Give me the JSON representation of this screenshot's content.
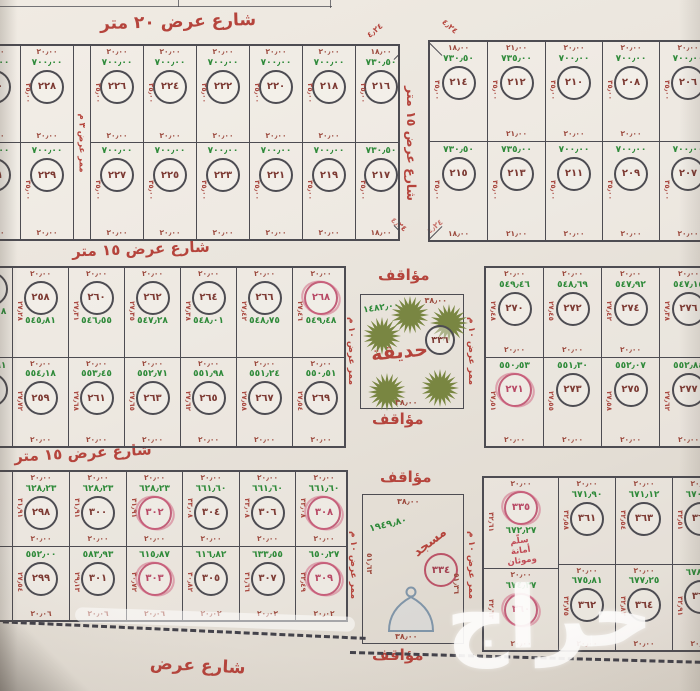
{
  "colors": {
    "red": "#b5443c",
    "maroon": "#9c4a3e",
    "green": "#2f8a3a",
    "pink": "#c2607a",
    "line": "#4d4c52",
    "paper": "#eae5dd"
  },
  "streets": {
    "top": "شارع عرض ٢٠ متر",
    "between_blocks": "شارع عرض ١٥ متر",
    "middle_a": "شارع عرض ١٥ متر",
    "middle_b": "شارع عرض ١٥ متر",
    "bottom": "شارع عرض",
    "corner_dim": "٤٫٢٤"
  },
  "labels": {
    "parking": "مؤاقف",
    "walkway_10": "ممر عرض ١٠ م",
    "walkway_3": "ممر عرض ٣ م"
  },
  "park": {
    "title": "حديقة",
    "number": "٣٣٦",
    "area": "١٤٨٢٫٠٠",
    "width_top": "٣٨٫٠٠",
    "width_bottom": "٣٨٫٠٠",
    "trees": [
      {
        "x": 49,
        "y": 20
      },
      {
        "x": 21,
        "y": 41
      },
      {
        "x": 88,
        "y": 28
      },
      {
        "x": 26,
        "y": 97
      },
      {
        "x": 79,
        "y": 93
      }
    ]
  },
  "mosque": {
    "title": "مسجد",
    "number": "٣٣٤",
    "area": "١٩٤٩٫٨٠",
    "width_top": "٣٨٫٠٠",
    "width_bottom": "٣٨٫٠٠",
    "side_left": "٥١٫٦٣",
    "side_right": "٥١٫٣٦"
  },
  "watermark": "حراج",
  "blocks": {
    "top_left": {
      "columns": [
        {
          "w": 52,
          "ml": -32,
          "top": {
            "wt": "٢٠٫٠٠",
            "area": "٧٠٠٫٠٠",
            "num": "٢٣٠",
            "side": "٣٥٫٠٠",
            "wb": "٢٠٫٠٠"
          },
          "bottom": {
            "area": "٧٠٠٫٠٠",
            "num": "٢٣١",
            "side": "٣٥٫٠٠",
            "wb": "٢٠٫٠٠"
          }
        },
        {
          "w": 52,
          "top": {
            "wt": "٢٠٫٠٠",
            "area": "٧٠٠٫٠٠",
            "num": "٢٢٨",
            "side": "٣٥٫٠٠",
            "wb": "٢٠٫٠٠"
          },
          "bottom": {
            "area": "٧٠٠٫٠٠",
            "num": "٢٢٩",
            "side": "٣٥٫٠٠",
            "wb": "٢٠٫٠٠"
          }
        },
        {
          "w": 16,
          "walkway": true
        },
        {
          "w": 52,
          "top": {
            "wt": "٢٠٫٠٠",
            "area": "٧٠٠٫٠٠",
            "num": "٢٢٦",
            "side": "٣٥٫٠٠",
            "wb": "٢٠٫٠٠"
          },
          "bottom": {
            "area": "٧٠٠٫٠٠",
            "num": "٢٢٧",
            "side": "٣٥٫٠٠",
            "wb": "٢٠٫٠٠"
          }
        },
        {
          "w": 52,
          "top": {
            "wt": "٢٠٫٠٠",
            "area": "٧٠٠٫٠٠",
            "num": "٢٢٤",
            "side": "٣٥٫٠٠",
            "wb": "٢٠٫٠٠"
          },
          "bottom": {
            "area": "٧٠٠٫٠٠",
            "num": "٢٢٥",
            "side": "٣٥٫٠٠",
            "wb": "٢٠٫٠٠"
          }
        },
        {
          "w": 52,
          "top": {
            "wt": "٢٠٫٠٠",
            "area": "٧٠٠٫٠٠",
            "num": "٢٢٢",
            "side": "٣٥٫٠٠",
            "wb": "٢٠٫٠٠"
          },
          "bottom": {
            "area": "٧٠٠٫٠٠",
            "num": "٢٢٣",
            "side": "٣٥٫٠٠",
            "wb": "٢٠٫٠٠"
          }
        },
        {
          "w": 52,
          "top": {
            "wt": "٢٠٫٠٠",
            "area": "٧٠٠٫٠٠",
            "num": "٢٢٠",
            "side": "٣٥٫٠٠",
            "wb": "٢٠٫٠٠"
          },
          "bottom": {
            "area": "٧٠٠٫٠٠",
            "num": "٢٢١",
            "side": "٣٥٫٠٠",
            "wb": "٢٠٫٠٠"
          }
        },
        {
          "w": 52,
          "top": {
            "wt": "٢٠٫٠٠",
            "area": "٧٠٠٫٠٠",
            "num": "٢١٨",
            "side": "٣٥٫٠٠",
            "wb": "٢٠٫٠٠"
          },
          "bottom": {
            "area": "٧٠٠٫٠٠",
            "num": "٢١٩",
            "side": "٣٥٫٠٠",
            "wb": "٢٠٫٠٠"
          }
        },
        {
          "w": 50,
          "top": {
            "wt": "١٨٫٠٠",
            "area": "٧٣٠٫٥٠",
            "num": "٢١٦",
            "side": "٣٥٫٠٠",
            "cut": "tr"
          },
          "bottom": {
            "area": "٧٣٠٫٥٠",
            "num": "٢١٧",
            "side": "٣٥٫٠٠",
            "wb": "١٨٫٠٠",
            "cut": "br"
          }
        }
      ]
    },
    "top_right": {
      "columns": [
        {
          "w": 57,
          "top": {
            "wt": "١٨٫٠٠",
            "area": "٧٣٠٫٥٠",
            "num": "٢١٤",
            "side": "٣٥٫٠٠",
            "cut": "tl"
          },
          "bottom": {
            "area": "٧٣٠٫٥٠",
            "num": "٢١٥",
            "side": "٣٥٫٠٠",
            "wb": "١٨٫٠٠",
            "cut": "bl"
          }
        },
        {
          "w": 57,
          "top": {
            "wt": "٢١٫٠٠",
            "area": "٧٣٥٫٠٠",
            "num": "٢١٢",
            "side": "٣٥٫٠٠",
            "wb": "٢١٫٠٠"
          },
          "bottom": {
            "area": "٧٣٥٫٠٠",
            "num": "٢١٣",
            "side": "٣٥٫٠٠",
            "wb": "٢١٫٠٠"
          }
        },
        {
          "w": 56,
          "top": {
            "wt": "٢٠٫٠٠",
            "area": "٧٠٠٫٠٠",
            "num": "٢١٠",
            "side": "٣٥٫٠٠",
            "wb": "٢٠٫٠٠"
          },
          "bottom": {
            "area": "٧٠٠٫٠٠",
            "num": "٢١١",
            "side": "٣٥٫٠٠",
            "wb": "٢٠٫٠٠"
          }
        },
        {
          "w": 56,
          "top": {
            "wt": "٢٠٫٠٠",
            "area": "٧٠٠٫٠٠",
            "num": "٢٠٨",
            "side": "٣٥٫٠٠",
            "wb": "٢٠٫٠٠"
          },
          "bottom": {
            "area": "٧٠٠٫٠٠",
            "num": "٢٠٩",
            "side": "٣٥٫٠٠",
            "wb": "٢٠٫٠٠"
          }
        },
        {
          "w": 56,
          "mr": -10,
          "top": {
            "wt": "٢٠٫٠٠",
            "area": "٧٠٠٫٠٠",
            "num": "٢٠٦",
            "side": "٣٥٫٠٠"
          },
          "bottom": {
            "area": "٧٠٠٫٠٠",
            "num": "٢٠٧",
            "side": "٣٥٫٠٠",
            "wb": "٢٠٫٠٠"
          }
        }
      ]
    },
    "mid_left": {
      "columns": [
        {
          "w": 42,
          "ml": -30,
          "top": {
            "num": "٢٥٦",
            "area": "٥٤٥٫٠٨"
          },
          "bottom": {
            "num": "٢٥٧",
            "area": "٥٥٤٫٩١"
          }
        },
        {
          "w": 55,
          "top": {
            "wt": "٢٠٫٠٠",
            "num": "٢٥٨",
            "area": "٥٤٥٫٨١",
            "side": "٢٧٫٢٨"
          },
          "bottom": {
            "wt": "٢٠٫٠٠",
            "area": "٥٥٤٫١٨",
            "num": "٢٥٩",
            "side": "٢٧٫٧٢",
            "wb": "٢٠٫٠٠"
          }
        },
        {
          "w": 55,
          "top": {
            "wt": "٢٠٫٠٠",
            "num": "٢٦٠",
            "area": "٥٤٦٫٥٥",
            "side": "٢٧٫٣١"
          },
          "bottom": {
            "wt": "٢٠٫٠٠",
            "area": "٥٥٣٫٤٥",
            "num": "٢٦١",
            "side": "٢٧٫٦٨",
            "wb": "٢٠٫٠٠"
          }
        },
        {
          "w": 55,
          "top": {
            "wt": "٢٠٫٠٠",
            "num": "٢٦٢",
            "area": "٥٤٧٫٢٨",
            "side": "٢٧٫٣٥"
          },
          "bottom": {
            "wt": "٢٠٫٠٠",
            "area": "٥٥٢٫٧١",
            "num": "٢٦٣",
            "side": "٢٧٫٦٥",
            "wb": "٢٠٫٠٠"
          }
        },
        {
          "w": 55,
          "top": {
            "wt": "٢٠٫٠٠",
            "num": "٢٦٤",
            "area": "٥٤٨٫٠١",
            "side": "٢٧٫٣٨"
          },
          "bottom": {
            "wt": "٢٠٫٠٠",
            "area": "٥٥١٫٩٨",
            "num": "٢٦٥",
            "side": "٢٧٫٦٢",
            "wb": "٢٠٫٠٠"
          }
        },
        {
          "w": 55,
          "top": {
            "wt": "٢٠٫٠٠",
            "num": "٢٦٦",
            "area": "٥٤٨٫٧٥",
            "side": "٢٧٫٤٢"
          },
          "bottom": {
            "wt": "٢٠٫٠٠",
            "area": "٥٥١٫٢٤",
            "num": "٢٦٧",
            "side": "٢٧٫٥٨",
            "wb": "٢٠٫٠٠"
          }
        },
        {
          "w": 56,
          "top": {
            "wt": "٢٠٫٠٠",
            "num": "٢٦٨",
            "area": "٥٤٩٫٤٨",
            "side": "٢٧٫٤٦",
            "pink": true
          },
          "bottom": {
            "wt": "٢٠٫٠٠",
            "area": "٥٥٠٫٥١",
            "num": "٢٦٩",
            "side": "٢٧٫٥٤",
            "wb": "٢٠٫٠٠"
          }
        }
      ]
    },
    "mid_right": {
      "columns": [
        {
          "w": 57,
          "top": {
            "wt": "٢٠٫٠٠",
            "area": "٥٤٩٫٤٦",
            "num": "٢٧٠",
            "side": "٢٧٫٤٨",
            "wb": "٢٠٫٠٠"
          },
          "bottom": {
            "area": "٥٥٠٫٥٣",
            "num": "٢٧١",
            "side": "٢٧٫٥١",
            "wb": "٢٠٫٠٠",
            "pink": true
          }
        },
        {
          "w": 57,
          "top": {
            "wt": "٢٠٫٠٠",
            "area": "٥٤٨٫٦٩",
            "num": "٢٧٢",
            "side": "٢٧٫٤٥",
            "wb": "٢٠٫٠٠"
          },
          "bottom": {
            "area": "٥٥١٫٣٠",
            "num": "٢٧٣",
            "side": "٢٧٫٥٥",
            "wb": "٢٠٫٠٠"
          }
        },
        {
          "w": 57,
          "top": {
            "wt": "٢٠٫٠٠",
            "area": "٥٤٧٫٩٢",
            "num": "٢٧٤",
            "side": "٢٧٫٤٢",
            "wb": "٢٠٫٠٠"
          },
          "bottom": {
            "area": "٥٥٢٫٠٧",
            "num": "٢٧٥",
            "side": "٢٧٫٥٨",
            "wb": "٢٠٫٠٠"
          }
        },
        {
          "w": 57,
          "mr": -12,
          "top": {
            "wt": "٢٠٫٠٠",
            "area": "٥٤٧٫١٥",
            "num": "٢٧٦",
            "side": "٢٧٫٣٨"
          },
          "bottom": {
            "area": "٥٥٢٫٨٤",
            "num": "٢٧٧",
            "side": "٢٧٫٦٢",
            "wb": "٢٠٫٠٠"
          }
        }
      ]
    },
    "bottom_left": {
      "columns": [
        {
          "w": 30,
          "ml": -18,
          "top": {},
          "bottom": {}
        },
        {
          "w": 56,
          "top": {
            "wt": "٢٠٫٠٠",
            "area": "٦٢٨٫٢٣",
            "num": "٢٩٨",
            "side": "٣١٫٩١",
            "wb": "٢٠٫٠٠"
          },
          "bottom": {
            "area": "٥٥٢٫٠٠",
            "num": "٢٩٩",
            "side": "٢٧٫٥٤",
            "wb": "٢٠٫٠٦"
          }
        },
        {
          "w": 56,
          "top": {
            "wt": "٢٠٫٠٠",
            "area": "٦٢٨٫٢٣",
            "num": "٣٠٠",
            "side": "٣١٫٩١",
            "wb": "٢٠٫٠٠"
          },
          "bottom": {
            "area": "٥٨٣٫٩٣",
            "num": "٣٠١",
            "side": "٢٩٫١٣",
            "wb": "٢٠٫٠٦"
          }
        },
        {
          "w": 55,
          "top": {
            "wt": "٢٠٫٠٠",
            "area": "٦٢٨٫٢٣",
            "num": "٣٠٢",
            "side": "٣١٫٩١",
            "wb": "٢٠٫٠٠",
            "pink": true
          },
          "bottom": {
            "area": "٦١٥٫٨٧",
            "num": "٣٠٣",
            "side": "٣٠٫٧٢",
            "wb": "٢٠٫٠٦",
            "pink": true
          }
        },
        {
          "w": 56,
          "top": {
            "wt": "٢٠٫٠٠",
            "area": "٦٦١٫٦٠",
            "num": "٣٠٤",
            "side": "٣٣٫٠٨",
            "wb": "٢٠٫٠٠"
          },
          "bottom": {
            "area": "٦١٦٫٨٢",
            "num": "٣٠٥",
            "side": "٣٠٫٨٢",
            "wb": "٢٠٫٠٢"
          }
        },
        {
          "w": 55,
          "top": {
            "wt": "٢٠٫٠٠",
            "area": "٦٦١٫٦٠",
            "num": "٣٠٦",
            "side": "٣٣٫٠٨",
            "wb": "٢٠٫٠٠"
          },
          "bottom": {
            "area": "٦٣٣٫٥٥",
            "num": "٣٠٧",
            "side": "٣١٫٦٦",
            "wb": "٢٠٫٠٢"
          }
        },
        {
          "w": 56,
          "top": {
            "wt": "٢٠٫٠٠",
            "area": "٦٦١٫٦٠",
            "num": "٣٠٨",
            "side": "٣٣٫٠٨",
            "wb": "٢٠٫٠٠",
            "pink": true
          },
          "bottom": {
            "area": "٦٥٠٫٢٧",
            "num": "٣٠٩",
            "side": "٣٢٫٤٩",
            "wb": "٢٠٫٠٢",
            "pink": true
          }
        }
      ]
    },
    "bottom_right": {
      "columns": [
        {
          "w": 74,
          "top": {
            "wt": "٢٠٫٠٠",
            "num": "٣٣٥",
            "pink": true,
            "area": "٦٧٢٫٢٧",
            "side": "٣٢٫٦١",
            "order": "wcan",
            "note": [
              "سلّم",
              "أمانة",
              "وموثان"
            ]
          },
          "bottom": {
            "wt": "٢٠٫٠٠",
            "area": "٦٧٤٫٣٧",
            "num": "٣٦٠",
            "side": "٣٢٫٦٣",
            "wb": "٢٠٫٠٠",
            "pink": true
          }
        },
        {
          "w": 56,
          "top": {
            "wt": "٢٠٫٠٠",
            "area": "٦٧١٫٩٠",
            "num": "٣٦١",
            "side": "٣٢٫٥٨"
          },
          "bottom": {
            "wt": "٢٠٫٠٠",
            "area": "٦٧٥٫٨١",
            "num": "٣٦٢",
            "side": "٣٢٫٧٥",
            "wb": "٢٠٫٠٠"
          }
        },
        {
          "w": 56,
          "top": {
            "wt": "٢٠٫٠٠",
            "area": "٦٧١٫١٢",
            "num": "٣٦٣",
            "side": "٣٢٫٥٤"
          },
          "bottom": {
            "wt": "٢٠٫٠٠",
            "area": "٦٧٧٫٢٥",
            "num": "٣٦٤",
            "side": "٣٢٫٨٣",
            "wb": "٢٠٫٠٠"
          }
        },
        {
          "w": 56,
          "mr": -24,
          "top": {
            "wt": "٢٠٫٠٠",
            "area": "٦٧٠٫٣٤",
            "num": "٣٦٥",
            "side": "٣٢٫٥١"
          },
          "bottom": {
            "area": "٦٧٨٫٦٩",
            "num": "٣٦٦",
            "side": "٣٢٫٩١",
            "wb": "٢٠٫٠٠"
          }
        }
      ]
    }
  }
}
